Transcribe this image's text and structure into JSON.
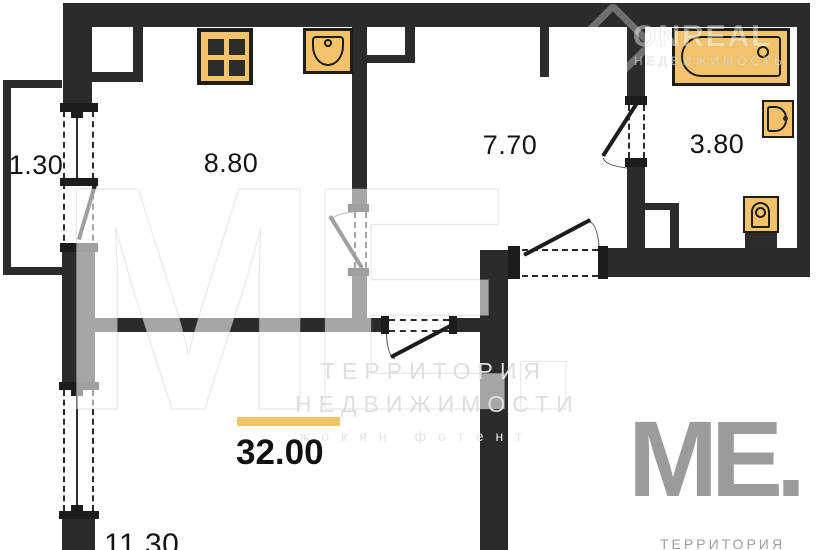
{
  "colors": {
    "wall": "#2b2b29",
    "fixture_fill": "#f2c36b",
    "fixture_stroke": "#1d1d1b",
    "accent_bar": "#f2c468",
    "watermark_gray": "#9b9b9b"
  },
  "rooms": [
    {
      "id": "balcony",
      "area": "1.30"
    },
    {
      "id": "kitchen",
      "area": "8.80"
    },
    {
      "id": "hall",
      "area": "7.70"
    },
    {
      "id": "bathroom",
      "area": "3.80"
    },
    {
      "id": "bedroom",
      "area": "11.30"
    }
  ],
  "total_area": "32.00",
  "fixtures": [
    "stove-icon",
    "kitchen-sink-icon",
    "bathtub-icon",
    "washbasin-icon",
    "toilet-icon"
  ],
  "watermarks": {
    "top_right": {
      "brand": "ONREAL",
      "subtitle": "НЕДВИЖИМОСТЬ"
    },
    "center": {
      "logo": "ME.",
      "line1": "ТЕРРИТОРИЯ",
      "line2": "НЕДВИЖИМОСТИ",
      "line3": "жокян фотент"
    },
    "bottom_right": {
      "logo": "ME.",
      "caption": "ТЕРРИТОРИЯ"
    }
  }
}
